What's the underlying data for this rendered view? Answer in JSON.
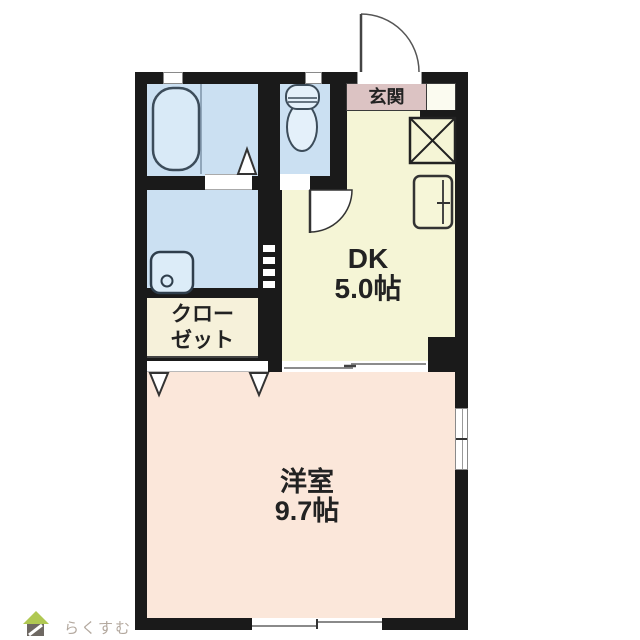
{
  "page": {
    "background": "#ffffff"
  },
  "logo": {
    "text": "らくすむ",
    "text_color": "#b3a89e",
    "roof_color": "#b0c852",
    "house_color": "#6e6862"
  },
  "floorplan": {
    "wall_color": "#1a1a1a",
    "rooms": {
      "dk": {
        "label": "DK",
        "size": "5.0帖",
        "fill": "#f5f5d6"
      },
      "western_room": {
        "label": "洋室",
        "size": "9.7帖",
        "fill": "#fbe7da"
      },
      "closet": {
        "label_line1": "クロー",
        "label_line2": "ゼット",
        "fill": "#f6f1da"
      },
      "entrance": {
        "label": "玄関",
        "fill": "#dcc3c3"
      },
      "bathroom": {
        "fill": "#cbe0f2"
      },
      "washroom": {
        "fill": "#cbe0f2"
      },
      "toilet_room": {
        "fill": "#cbe0f2"
      }
    },
    "fixture_icons": [
      "bathtub-icon",
      "toilet-icon",
      "wash-basin-icon",
      "refrigerator-icon",
      "storage-cross-icon",
      "entrance-door-arc-icon",
      "toilet-door-arc-icon",
      "closet-folding-door-icon",
      "sliding-door-symbol",
      "window-symbol"
    ]
  }
}
